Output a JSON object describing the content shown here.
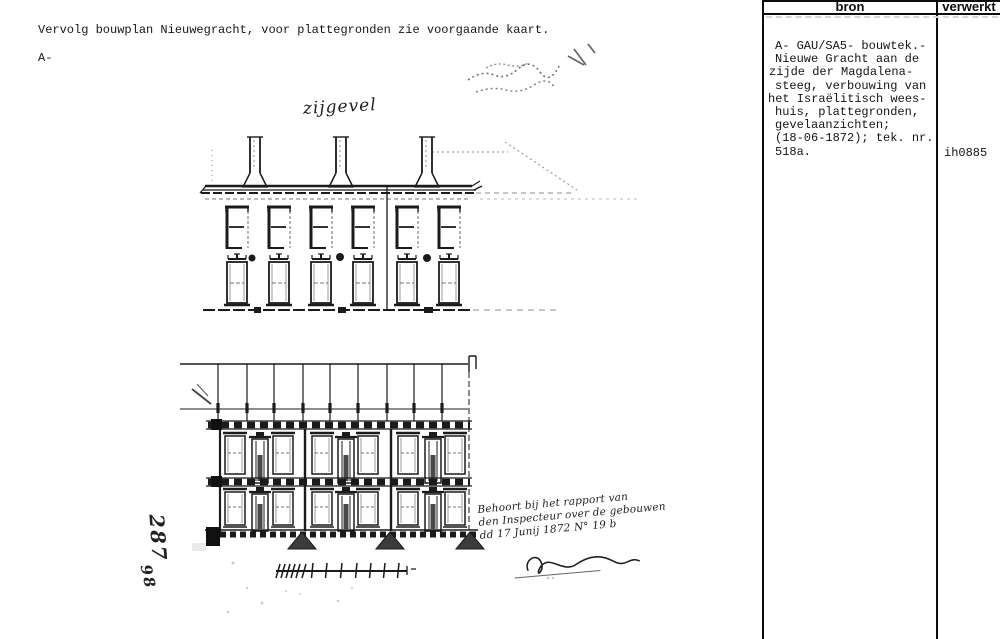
{
  "document": {
    "note": "Vervolg bouwplan Nieuwegracht, voor plattegronden zie voorgaande kaart.",
    "marker": "A-"
  },
  "drawing": {
    "facade_label": "zijgevel",
    "margin_number_top": "287",
    "margin_number_bottom": "98",
    "signature_lines": [
      "Behoort bij het rapport van",
      "den Inspecteur over de gebouwen",
      "dd 17 Junij 1872 N° 19 b"
    ]
  },
  "table": {
    "headers": {
      "bron": "bron",
      "verwerkt": "verwerkt"
    },
    "bron_lines": [
      "A- GAU/SA5- bouwtek.-",
      "Nieuwe Gracht aan de",
      "zijde der Magdalena-",
      "steeg, verbouwing van",
      "het Israëlitisch wees-",
      "huis, plattegronden,",
      "gevelaanzichten;",
      "(18-06-1872); tek. nr.",
      "518a."
    ],
    "verwerkt_value": "ih0885"
  },
  "colors": {
    "ink": "#1b1b1b",
    "paper": "#ffffff"
  }
}
